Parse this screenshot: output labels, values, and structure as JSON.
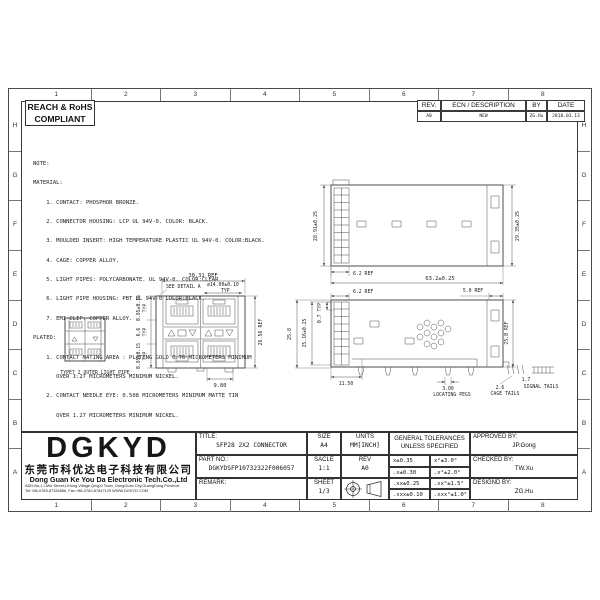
{
  "sheet": {
    "grid_columns": [
      "1",
      "2",
      "3",
      "4",
      "5",
      "6",
      "7",
      "8"
    ],
    "grid_rows": [
      "H",
      "G",
      "F",
      "E",
      "D",
      "C",
      "B",
      "A"
    ]
  },
  "compliance": {
    "line1": "REACH & RoHS",
    "line2": "COMPLIANT"
  },
  "revision_table": {
    "col_rev": "REV.",
    "col_desc": "ECN / DESCRIPTION",
    "col_by": "BY",
    "col_date": "DATE",
    "row": {
      "rev": "A0",
      "desc": "NEW",
      "by": "ZG.Hu",
      "date": "2018.03.13"
    }
  },
  "notes": {
    "lines": [
      "NOTE:",
      "MATERIAL:",
      "    1. CONTACT: PHOSPHOR BRONZE.",
      "    2. CONNECTOR HOUSING: LCP UL 94V-0. COLOR: BLACK.",
      "    3. MOULDED INSERT: HIGH TEMPERATURE PLASTIC UL 94V-0. COLOR:BLACK.",
      "    4. CAGE: COPPER ALLOY.",
      "    5. LIGHT PIPES: POLYCARBONATE. UL 94V-0. COLOR:CLEAR",
      "    6. LIGHT PIPE HOUSING: PBT UL 94V-0 COLOR:BLACK.",
      "    7. EMI CLIP: COPPER ALLOY.",
      "PLATED:",
      "    1. CONTACT MATING AREA : PLATING GOLD 0.76 MICROMETERS MINIMUM",
      "       OVER 1.27 MICROMETERS MINIMUM NICKEL.",
      "    2. CONTACT NEEDLE EYE: 0.508 MICROMETERS MINIMUM MATTE TIN",
      "       OVER 1.27 MICROMETERS MINIMUM NICKEL."
    ]
  },
  "drawing": {
    "front_view": {
      "width_dim": "30.31 REF",
      "detail_callout": "SEE DETAIL A",
      "pitch_dim": "⌀14.00±0.10",
      "typ_label": "TYP",
      "port_height_dim": "8.95±0.15",
      "mid_height_dim": "6.6",
      "height_dim": "26.56 REF",
      "foot_dim": "9.80"
    },
    "light_pipe_view": {
      "label": "TYPE7_2 OUTER LIGHT PIPE"
    },
    "top_view": {
      "left_height_dim": "28.91±0.25",
      "right_height_dim": "29.35±0.25",
      "bezel_dim": "6.2 REF",
      "length_dim": "63.2±0.25"
    },
    "side_view": {
      "bezel_dim": "6.2 REF",
      "rear_dim": "5.0 REF",
      "fin_pitch_dim": "0.7 TYP",
      "inner_height_dim": "25.16±0.25",
      "height_dim": "25.8",
      "rear_height_dim": "25.8 REF",
      "front_depth_dim": "11.50",
      "peg_dim": "3.00",
      "peg_label": "LOCATING PEGS",
      "cage_tail_dim": "2.6",
      "cage_tail_label": "CAGE TAILS",
      "signal_tail_dim": "1.7",
      "signal_tail_label": "SIGNAL TAILS"
    }
  },
  "title_block": {
    "company": {
      "logo": "DGKYD",
      "name_cn": "东莞市科优达电子科技有限公司",
      "name_en": "Dong Guan Ke You Da Electronic Tech.Co.,Ltd",
      "address": "ADD:No.1 LiWe Street,LiHong Village,QingXi Town, DongGuan City,GuangDong Province",
      "contact": "Tel:+86-0769-87334656, Fax:+86-0769-87847129  WWW.DGKYD.COM"
    },
    "title_label": "TITLE:",
    "title_value": "SFP28 2X2 CONNECTOR",
    "part_no_label": "PART NO.:",
    "part_no_value": "DGKYDSFP10732322F006057",
    "remark_label": "REMARK:",
    "size_label": "SIZE",
    "size_value": "A4",
    "units_label": "UNITS",
    "units_value": "MM[INCH]",
    "scale_label": "SACLE",
    "scale_value": "1:1",
    "rev_label": "REV",
    "rev_value": "A0",
    "sheet_label": "SHEET",
    "sheet_value": "1/3",
    "tolerances_title_1": "GENERAL TOLERANCES",
    "tolerances_title_2": "UNLESS SPECIFIED",
    "tol_rows": [
      {
        "lin": "x±0.35",
        "ang": "x°±3.0°"
      },
      {
        "lin": ".x±0.30",
        "ang": ".x°±2.0°"
      },
      {
        "lin": ".xx±0.25",
        "ang": ".xx°±1.5°"
      },
      {
        "lin": ".xxx±0.10",
        "ang": ".xxx°±1.0°"
      }
    ],
    "approved_label": "APPROVED BY:",
    "approved_value": "JP.Gong",
    "checked_label": "CHECKED BY:",
    "checked_value": "TW.Xu",
    "designed_label": "DESIGND BY:",
    "designed_value": "ZG.Hu"
  }
}
